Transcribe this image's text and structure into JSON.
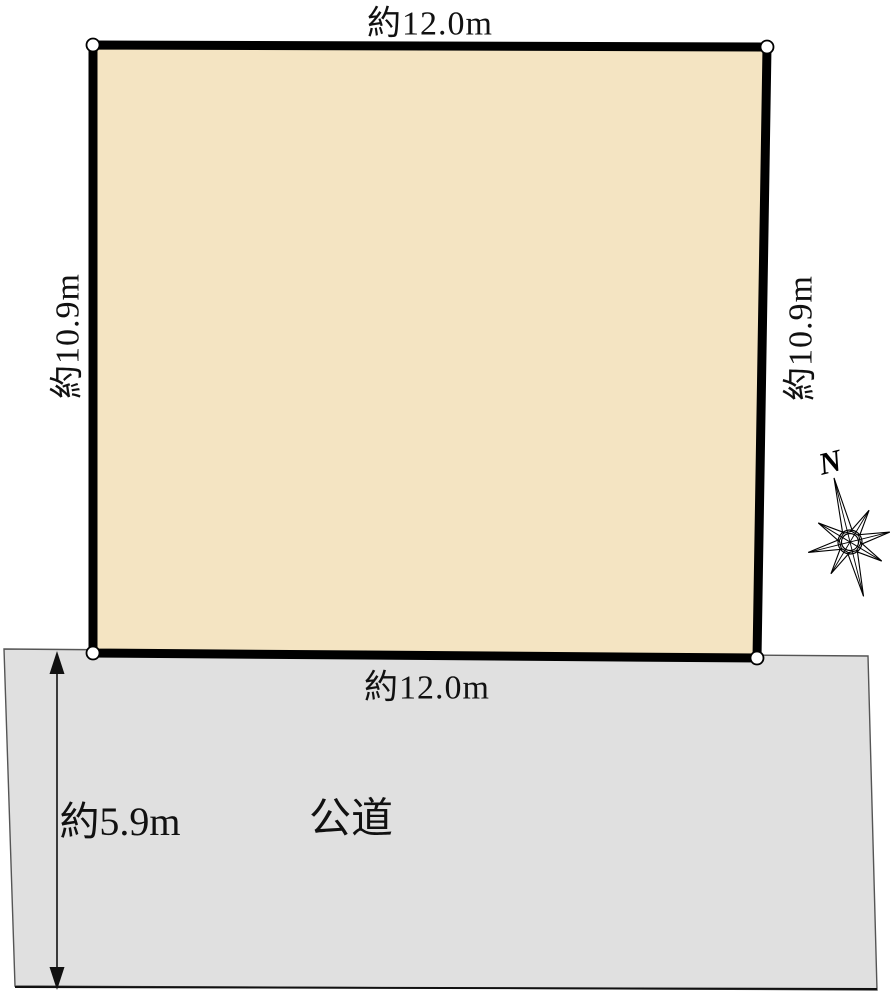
{
  "diagram": {
    "type": "land-plot-layout",
    "land": {
      "top_width_label": "約12.0m",
      "bottom_width_label": "約12.0m",
      "left_depth_label": "約10.9m",
      "right_depth_label": "約10.9m"
    },
    "road": {
      "name_label": "公道",
      "width_label": "約5.9m"
    },
    "compass": {
      "north_label": "N"
    },
    "colors": {
      "land_fill": "#f4e4c2",
      "land_border": "#000000",
      "road_fill": "#e0e0e0",
      "road_edge": "#555555",
      "line_color": "#111111",
      "text_color": "#111111",
      "bg_color": "#ffffff"
    }
  }
}
